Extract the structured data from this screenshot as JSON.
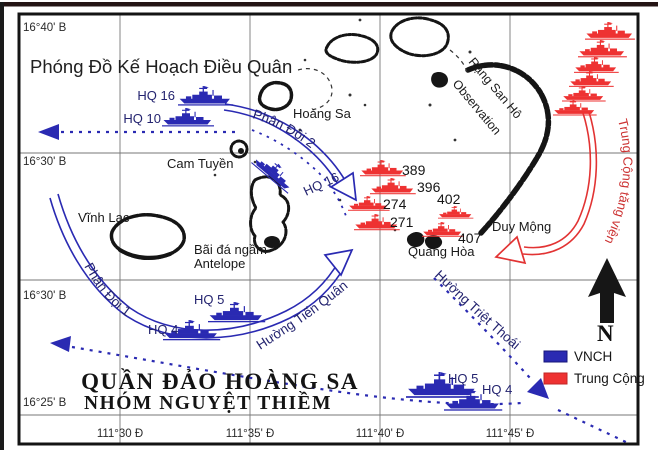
{
  "title": "Phóng Đồ Kế Hoạch Điều Quân",
  "region": {
    "line1": "QUẦN ĐẢO HOÀNG SA",
    "line2": "NHÓM NGUYỆT THIỀM"
  },
  "grid": {
    "lat": [
      "16°40' B",
      "16°30' B",
      "16°30' B",
      "16°25' B"
    ],
    "lon": [
      "111°30 Đ",
      "111°35' Đ",
      "111°40' Đ",
      "111°45' Đ"
    ]
  },
  "islands": {
    "hoang_sa": "Hoàng Sa",
    "cam_tuyen": "Cam Tuyền",
    "vinh_lac": "Vĩnh Lạc",
    "antelope_line1": "Bãi đá ngầm",
    "antelope_line2": "Antelope",
    "quang_hoa": "Quang Hòa",
    "duy_mong": "Duy Mộng",
    "reef_line1": "Rặng San Hô",
    "reef_line2": "Observation"
  },
  "routes": {
    "phan_doi_1": "Phân Đội 1",
    "phan_doi_2": "Phân Đội 2",
    "tien_quan": "Hường Tiến Quân",
    "triet_thoai": "Hường Triệt Thoái",
    "tang_vien": "Trung Cộng tăng viện"
  },
  "ships": {
    "hq16_top": "HQ 16",
    "hq10": "HQ 10",
    "hq16_mid": "HQ 16",
    "hq5_left": "HQ 5",
    "hq4_left": "HQ 4",
    "hq5_right": "HQ 5",
    "hq4_right": "HQ 4",
    "prc": [
      "389",
      "396",
      "274",
      "271",
      "402",
      "407"
    ]
  },
  "legend": {
    "vnch": "VNCH",
    "trung_cong": "Trung Cộng"
  },
  "compass": {
    "north": "N"
  },
  "colors": {
    "vnch": "#2a2ab2",
    "prc": "#ee3232"
  }
}
